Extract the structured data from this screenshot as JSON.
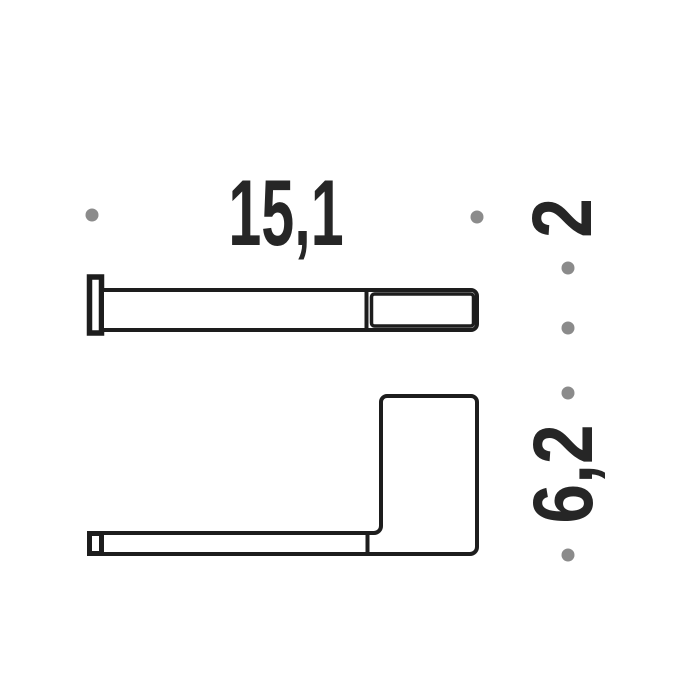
{
  "canvas": {
    "width": 700,
    "height": 700
  },
  "colors": {
    "background": "#ffffff",
    "line": "#1d1d1d",
    "text": "#262626",
    "dot": "#8b8b8b"
  },
  "dimension_labels": {
    "width": "15,1",
    "depth": "2",
    "height": "6,2"
  },
  "marker_dots": {
    "radius": 6.5,
    "points": [
      {
        "x": 92,
        "y": 215
      },
      {
        "x": 477,
        "y": 217
      },
      {
        "x": 568,
        "y": 268
      },
      {
        "x": 568,
        "y": 328
      },
      {
        "x": 568,
        "y": 393
      },
      {
        "x": 568,
        "y": 555
      }
    ]
  }
}
